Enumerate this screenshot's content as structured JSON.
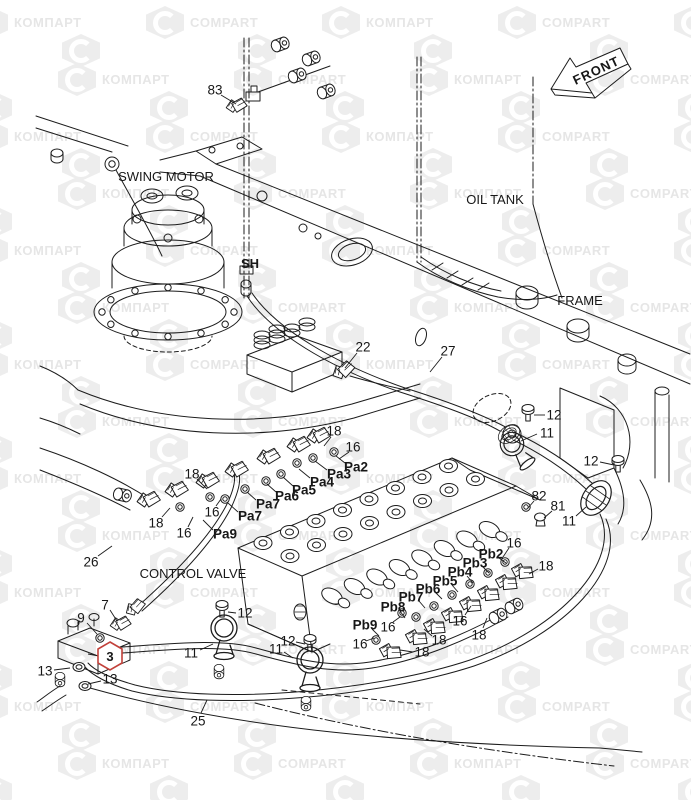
{
  "watermark": {
    "brand_a": "КОМПАРТ",
    "brand_b": "COMPART"
  },
  "colors": {
    "line": "#1c1c1c",
    "highlight_red": "#c2413a",
    "watermark_gray": "#ededed"
  },
  "labels": {
    "front": "FRONT",
    "swing_motor": "SWING MOTOR",
    "oil_tank": "OIL TANK",
    "frame": "FRAME",
    "control_valve": "CONTROL VALVE",
    "sh": "SH"
  },
  "highlight": {
    "text": "3",
    "x": 110,
    "y": 656
  },
  "callouts": [
    {
      "t": "83",
      "x": 215,
      "y": 90,
      "l": [
        221,
        95,
        236,
        104
      ]
    },
    {
      "t": "22",
      "x": 363,
      "y": 347,
      "l": [
        357,
        353,
        345,
        368
      ]
    },
    {
      "t": "27",
      "x": 448,
      "y": 351,
      "l": [
        442,
        357,
        430,
        372
      ]
    },
    {
      "t": "12",
      "x": 554,
      "y": 415,
      "l": [
        545,
        415,
        534,
        415
      ]
    },
    {
      "t": "11",
      "x": 547,
      "y": 433,
      "l": [
        537,
        434,
        521,
        441
      ]
    },
    {
      "t": "12",
      "x": 591,
      "y": 461,
      "l": [
        600,
        462,
        614,
        465
      ]
    },
    {
      "t": "18",
      "x": 334,
      "y": 431,
      "l": [
        331,
        437,
        324,
        446
      ]
    },
    {
      "t": "16",
      "x": 353,
      "y": 447,
      "l": [
        349,
        452,
        339,
        459
      ]
    },
    {
      "t": "Pa2",
      "k": "p",
      "x": 356,
      "y": 467,
      "l": [
        345,
        463,
        336,
        456
      ]
    },
    {
      "t": "Pa3",
      "k": "p",
      "x": 339,
      "y": 474,
      "l": [
        327,
        470,
        315,
        461
      ]
    },
    {
      "t": "Pa4",
      "k": "p",
      "x": 322,
      "y": 482,
      "l": [
        310,
        478,
        299,
        469
      ]
    },
    {
      "t": "Pa5",
      "k": "p",
      "x": 304,
      "y": 490,
      "l": [
        293,
        486,
        283,
        477
      ]
    },
    {
      "t": "Pa6",
      "k": "p",
      "x": 287,
      "y": 496,
      "l": [
        276,
        492,
        267,
        484
      ]
    },
    {
      "t": "Pa7",
      "k": "p",
      "x": 268,
      "y": 504,
      "l": [
        256,
        500,
        247,
        492
      ]
    },
    {
      "t": "Pa7",
      "k": "p",
      "x": 250,
      "y": 516,
      "l": [
        238,
        512,
        228,
        503
      ]
    },
    {
      "t": "Pa9",
      "k": "p",
      "x": 225,
      "y": 534,
      "l": [
        213,
        530,
        203,
        520
      ]
    },
    {
      "t": "18",
      "x": 192,
      "y": 474,
      "l": [
        197,
        479,
        207,
        489
      ]
    },
    {
      "t": "16",
      "x": 212,
      "y": 512,
      "l": [
        216,
        506,
        221,
        499
      ]
    },
    {
      "t": "18",
      "x": 156,
      "y": 523,
      "l": [
        162,
        517,
        170,
        508
      ]
    },
    {
      "t": "16",
      "x": 184,
      "y": 533,
      "l": [
        188,
        527,
        193,
        517
      ]
    },
    {
      "t": "26",
      "x": 91,
      "y": 562,
      "l": [
        98,
        556,
        112,
        546
      ]
    },
    {
      "t": "82",
      "x": 539,
      "y": 496,
      "l": [
        534,
        501,
        528,
        508
      ]
    },
    {
      "t": "81",
      "x": 558,
      "y": 506,
      "l": [
        552,
        511,
        544,
        518
      ]
    },
    {
      "t": "11",
      "x": 569,
      "y": 521,
      "l": [
        576,
        516,
        586,
        507
      ]
    },
    {
      "t": "16",
      "x": 514,
      "y": 543,
      "l": [
        509,
        548,
        503,
        557
      ]
    },
    {
      "t": "Pb2",
      "k": "p",
      "x": 491,
      "y": 554,
      "l": [
        499,
        558,
        506,
        563
      ]
    },
    {
      "t": "Pb3",
      "k": "p",
      "x": 475,
      "y": 563,
      "l": [
        483,
        567,
        489,
        573
      ]
    },
    {
      "t": "Pb4",
      "k": "p",
      "x": 460,
      "y": 572,
      "l": [
        467,
        576,
        473,
        583
      ]
    },
    {
      "t": "Pb5",
      "k": "p",
      "x": 445,
      "y": 581,
      "l": [
        452,
        585,
        458,
        592
      ]
    },
    {
      "t": "Pb6",
      "k": "p",
      "x": 428,
      "y": 589,
      "l": [
        436,
        593,
        442,
        599
      ]
    },
    {
      "t": "Pb7",
      "k": "p",
      "x": 411,
      "y": 597,
      "l": [
        419,
        601,
        425,
        608
      ]
    },
    {
      "t": "Pb8",
      "k": "p",
      "x": 393,
      "y": 607,
      "l": [
        400,
        611,
        405,
        618
      ]
    },
    {
      "t": "Pb9",
      "k": "p",
      "x": 365,
      "y": 625,
      "l": [
        372,
        629,
        379,
        636
      ]
    },
    {
      "t": "18",
      "x": 546,
      "y": 566,
      "l": [
        538,
        569,
        529,
        574
      ]
    },
    {
      "t": "16",
      "x": 460,
      "y": 621,
      "l": [
        465,
        615,
        471,
        606
      ]
    },
    {
      "t": "18",
      "x": 479,
      "y": 635,
      "l": [
        483,
        628,
        487,
        618
      ]
    },
    {
      "t": "16",
      "x": 388,
      "y": 627,
      "l": [
        393,
        622,
        400,
        617
      ]
    },
    {
      "t": "16",
      "x": 360,
      "y": 644,
      "l": [
        366,
        641,
        374,
        638
      ]
    },
    {
      "t": "18",
      "x": 439,
      "y": 640,
      "l": [
        432,
        636,
        424,
        629
      ]
    },
    {
      "t": "18",
      "x": 422,
      "y": 652,
      "l": [
        413,
        652,
        400,
        650
      ]
    },
    {
      "t": "9",
      "x": 81,
      "y": 618,
      "l": [
        87,
        623,
        97,
        634
      ]
    },
    {
      "t": "7",
      "x": 105,
      "y": 605,
      "l": [
        110,
        610,
        117,
        621
      ]
    },
    {
      "t": "13",
      "x": 45,
      "y": 671,
      "l": [
        54,
        670,
        70,
        668
      ]
    },
    {
      "t": "13",
      "x": 110,
      "y": 679,
      "l": [
        101,
        681,
        88,
        684
      ]
    },
    {
      "t": "12",
      "x": 245,
      "y": 613,
      "l": [
        236,
        613,
        228,
        612
      ]
    },
    {
      "t": "11",
      "x": 191,
      "y": 653,
      "l": [
        200,
        650,
        213,
        644
      ]
    },
    {
      "t": "12",
      "x": 288,
      "y": 641,
      "l": [
        296,
        642,
        305,
        644
      ]
    },
    {
      "t": "11",
      "x": 276,
      "y": 649,
      "l": [
        284,
        652,
        293,
        658
      ]
    },
    {
      "t": "25",
      "x": 198,
      "y": 721,
      "l": [
        201,
        713,
        207,
        700
      ]
    }
  ]
}
